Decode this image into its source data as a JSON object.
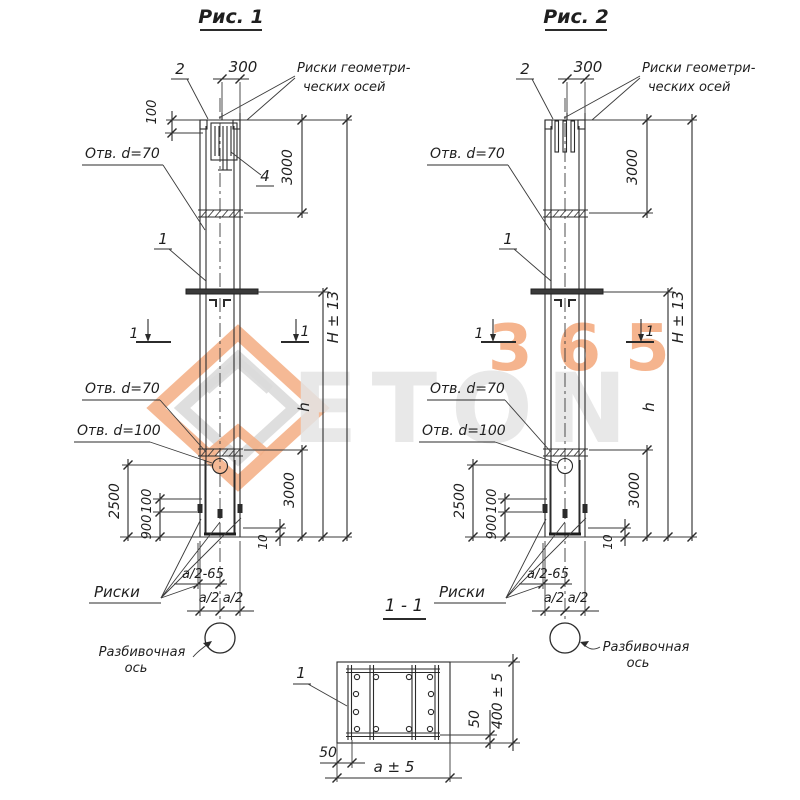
{
  "watermark": {
    "number": "365",
    "word": "ETON",
    "orange": "#f4ae84",
    "gray": "#d9d9d9"
  },
  "fig1": {
    "title": "Рис. 1",
    "mark_2": "2",
    "dim_300": "300",
    "risks_axes_1": "Риски геометри-",
    "risks_axes_2": "ческих осей",
    "dim_100_top": "100",
    "hole_d70_top": "Отв. d=70",
    "mark_4": "4",
    "dim_3000_top": "3000",
    "mark_1": "1",
    "cut_left": "1",
    "cut_right": "1",
    "dim_H": "H ± 13",
    "dim_h": "h",
    "hole_d70": "Отв. d=70",
    "hole_d100": "Отв. d=100",
    "dim_2500": "2500",
    "dim_100": "100",
    "dim_900": "900",
    "dim_3000_bottom": "3000",
    "dim_10": "10",
    "risks": "Риски",
    "dim_a2_65": "a/2-65",
    "dim_a2_l": "a/2",
    "dim_a2_r": "a/2",
    "axis_label_1": "Разбивочная",
    "axis_label_2": "ось"
  },
  "fig2": {
    "title": "Рис. 2",
    "mark_2": "2",
    "dim_300": "300",
    "risks_axes_1": "Риски геометри-",
    "risks_axes_2": "ческих осей",
    "hole_d70_top": "Отв. d=70",
    "dim_3000_top": "3000",
    "mark_1": "1",
    "cut_left": "1",
    "cut_right": "1",
    "dim_H": "H ± 13",
    "dim_h": "h",
    "hole_d70": "Отв. d=70",
    "hole_d100": "Отв. d=100",
    "dim_2500": "2500",
    "dim_100": "100",
    "dim_900": "900",
    "dim_3000_bottom": "3000",
    "dim_10": "10",
    "risks": "Риски",
    "dim_a2_65": "a/2-65",
    "dim_a2_l": "a/2",
    "dim_a2_r": "a/2",
    "axis_label_1": "Разбивочная",
    "axis_label_2": "ось"
  },
  "section": {
    "title": "1 - 1",
    "mark_1": "1",
    "dim_50_left": "50",
    "dim_50_right": "50",
    "dim_a": "a ± 5",
    "dim_400": "400 ± 5"
  }
}
